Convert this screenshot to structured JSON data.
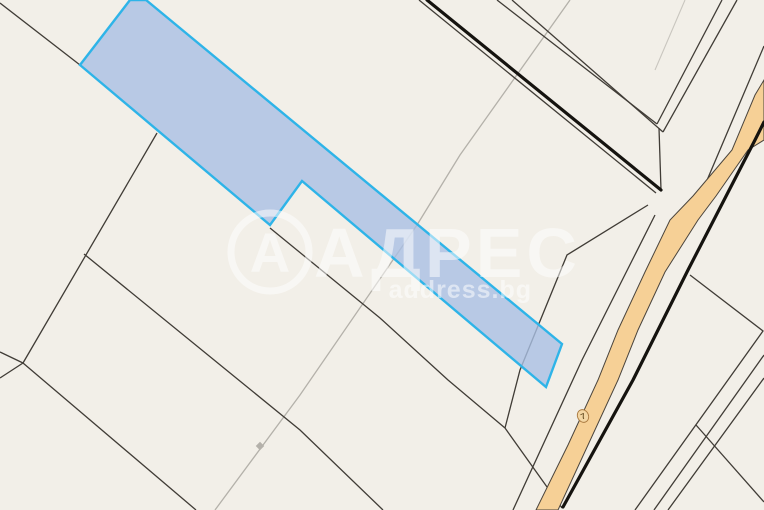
{
  "watermark": {
    "brand": "АДРЕС",
    "domain": "address.bg",
    "logo_letter": "А"
  },
  "road_marker": {
    "label": "7"
  },
  "colors": {
    "background": "#f2efe8",
    "parcel_fill": "#a9bfe3",
    "parcel_border": "#2eb4e8",
    "road_fill": "#f6d096",
    "boundary_line": "#403c36",
    "main_road_line": "#15130f",
    "secondary_line": "#b4b1aa",
    "watermark": "#ffffff"
  }
}
